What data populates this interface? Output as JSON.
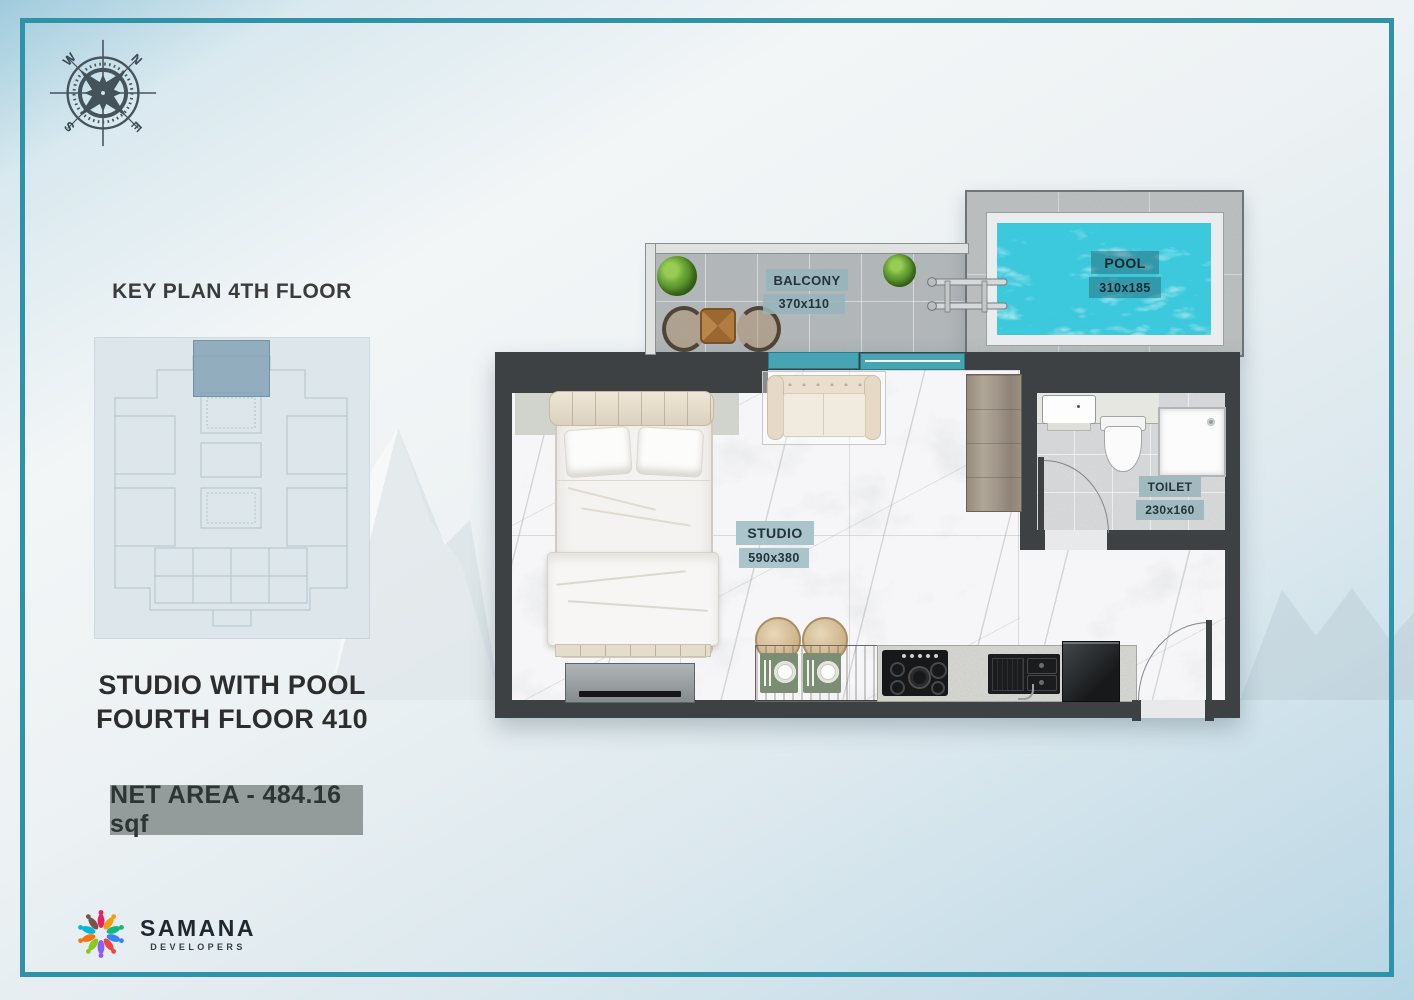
{
  "title_block": {
    "key_plan_title": "KEY PLAN 4TH FLOOR",
    "unit_line1": "STUDIO WITH POOL",
    "unit_line2": "FOURTH FLOOR 410",
    "net_area": "NET AREA - 484.16 sqf"
  },
  "compass": {
    "north": "N",
    "east": "E",
    "south": "S",
    "west": "W"
  },
  "brand": {
    "name": "SAMANA",
    "tagline": "DEVELOPERS"
  },
  "rooms": {
    "balcony": {
      "label": "BALCONY",
      "size": "370x110"
    },
    "pool": {
      "label": "POOL",
      "size": "310x185"
    },
    "studio": {
      "label": "STUDIO",
      "size": "590x380"
    },
    "toilet": {
      "label": "TOILET",
      "size": "230x160"
    }
  },
  "colors": {
    "frame_teal": "#2e93a8",
    "wall_dark": "#3d4144",
    "pool_water": "#35c3d8",
    "door_teal": "#47a5b3",
    "label_teal_bg": "#a9c5cb",
    "net_area_bg": "#939c9b"
  }
}
